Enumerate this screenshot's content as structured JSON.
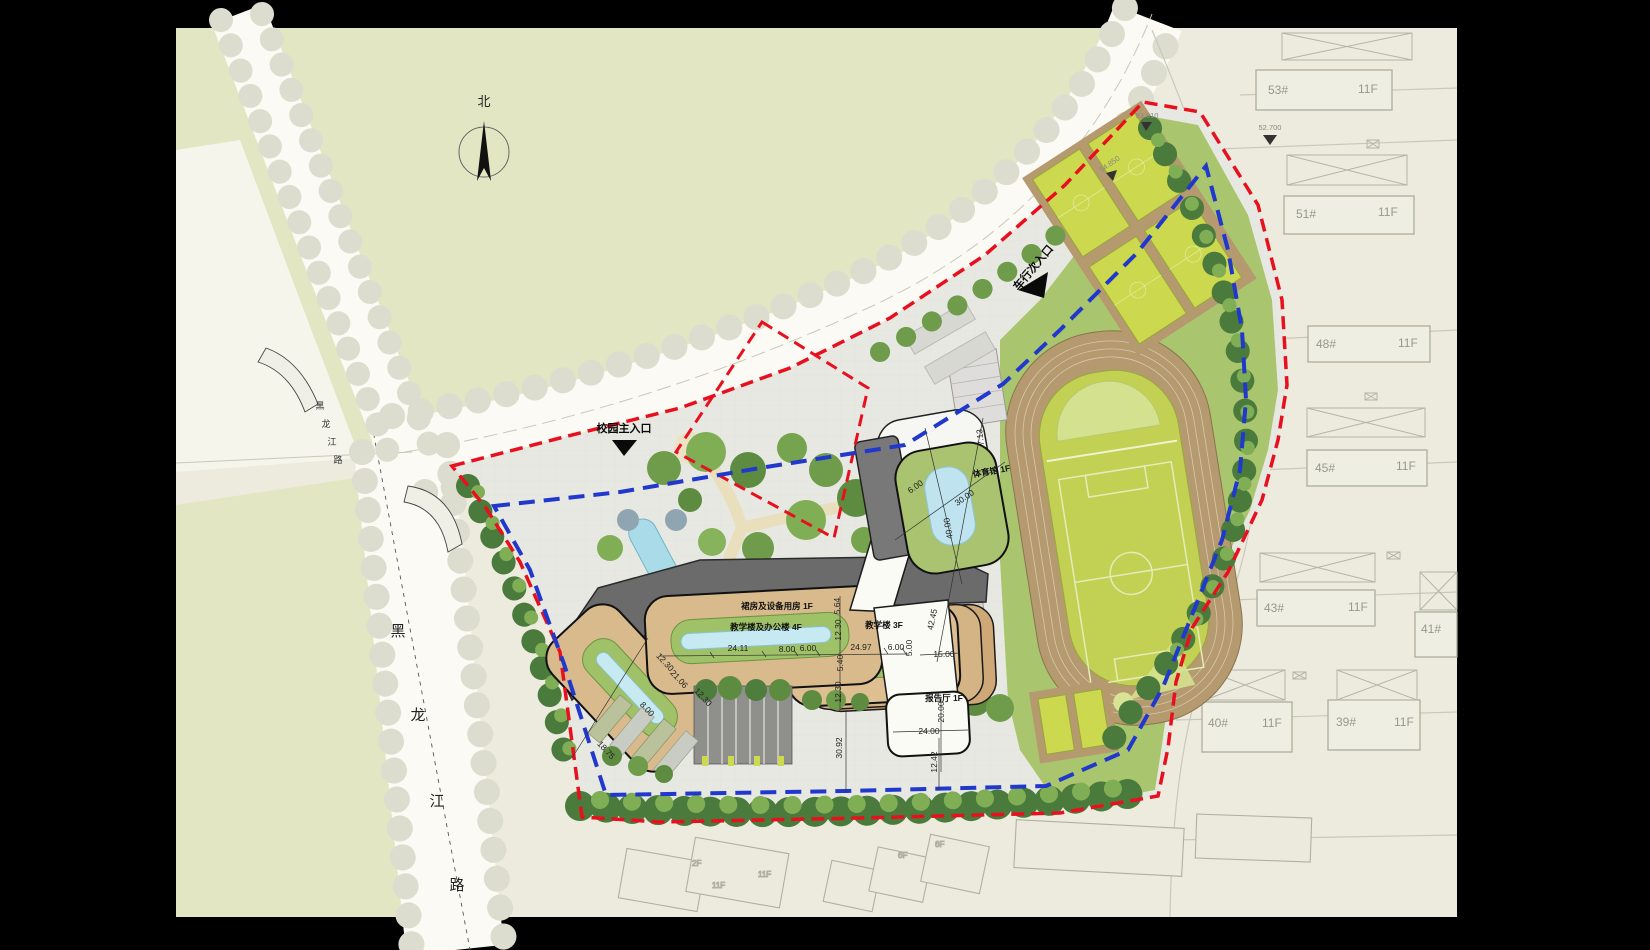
{
  "compass": {
    "north_label": "北"
  },
  "roads": {
    "upper": [
      "黑",
      "龙",
      "江",
      "路"
    ],
    "lower": [
      "黑",
      "龙",
      "江",
      "路"
    ]
  },
  "entrances": {
    "main": "校园主入口",
    "vehicle": "车行次入口"
  },
  "school": {
    "podium": "裙房及设备用房 1F",
    "teaching_office": "教学楼及办公楼 4F",
    "teaching": "教学楼 3F",
    "gym": "体育馆 1F",
    "lecture_hall": "报告厅 1F"
  },
  "dims": {
    "a1": "24.11",
    "a2": "8.00",
    "a3": "6.00",
    "a4": "24.97",
    "a5": "6.00",
    "a6": "5.00",
    "a7": "5.40",
    "a8": "12.30",
    "a9": "12.30",
    "a10": "5.64",
    "a11": "12.30",
    "a12": "21.06",
    "a13": "12.30",
    "a14": "8.00",
    "a15": "18.75",
    "a16": "30.92",
    "a17": "12.42",
    "a18": "24.00",
    "a19": "20.00",
    "a20": "30.00",
    "a21": "40.00",
    "a22": "6.00",
    "a23": "7.13",
    "a24": "42.45",
    "a25": "15.00"
  },
  "elevations": {
    "e1": "52.700",
    "e2": "53.910",
    "e3": "54.850"
  },
  "residential": [
    {
      "id": "53#",
      "floors": "11F"
    },
    {
      "id": "51#",
      "floors": "11F"
    },
    {
      "id": "48#",
      "floors": "11F"
    },
    {
      "id": "45#",
      "floors": "11F"
    },
    {
      "id": "43#",
      "floors": "11F"
    },
    {
      "id": "41#",
      "floors": ""
    },
    {
      "id": "40#",
      "floors": "11F"
    },
    {
      "id": "39#",
      "floors": "11F"
    }
  ],
  "south_buildings": {
    "s1": "2F",
    "s2": "11F",
    "s3": "11F",
    "s4": "6F",
    "s5": "6F"
  },
  "colors": {
    "boundary_red": "#e8101e",
    "setback_blue": "#2038cc",
    "building_tan": "#d8ba8c",
    "courtyard_green": "#9fc168",
    "pool_cyan": "#bfe2ee",
    "track_tan": "#b49a6e",
    "field_green": "#c2d153"
  }
}
